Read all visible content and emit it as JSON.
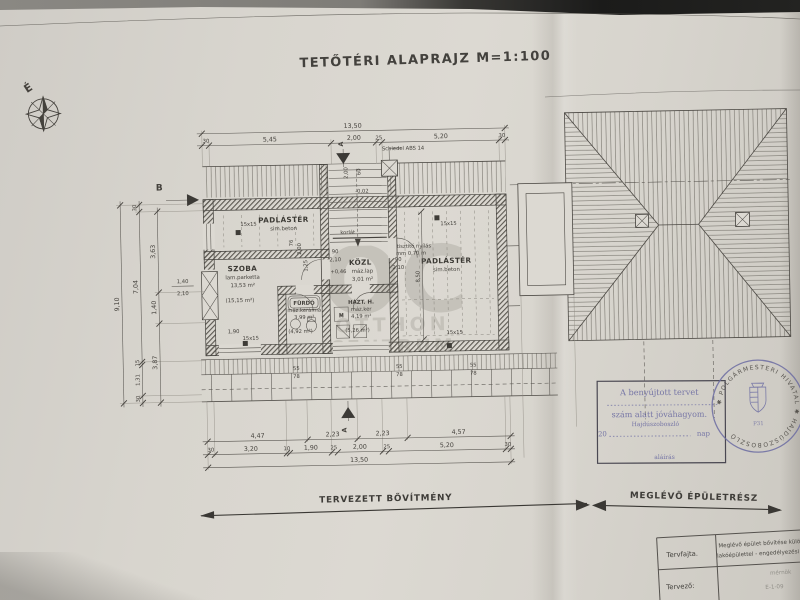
{
  "title": "TETŐTÉRI ALAPRAJZ M=1:100",
  "compass": {
    "north": "É"
  },
  "sections": {
    "a": "A",
    "b": "B"
  },
  "chimney_label": "Schiedel ABS 14",
  "rooms": {
    "attic_left": {
      "name": "PADLÁSTÉR",
      "finish": "sim.beton"
    },
    "szoba": {
      "name": "SZOBA",
      "finish": "lam.parketta",
      "area": "13,53 m²",
      "gross": "(15,15 m²)"
    },
    "kozl": {
      "name": "KÖZL",
      "finish": "máz.lap",
      "area": "3,01 m²",
      "level": "+0,46"
    },
    "furdo": {
      "name": "FÜRDŐ",
      "finish": "máz.kerámia",
      "area": "3,99 m²",
      "gross": "(4,92 m²)"
    },
    "hazt": {
      "name": "HÁZT. H.",
      "finish": "máz.ker",
      "area": "4,19 m²",
      "gross": "(5,26 m²)"
    },
    "attic_right": {
      "name": "PADLÁSTÉR",
      "finish": "sim.beton"
    }
  },
  "ann": {
    "korlat": "korlát",
    "tisztito1": "tisztító nyílás",
    "tisztito2": "mm 0,70 m",
    "column": "15x15",
    "washer": "M",
    "level_stair": "-0,02"
  },
  "dims": {
    "top_total": "13,50",
    "top_segments": [
      "30",
      "5,45",
      "2,00",
      "25",
      "5,20",
      "30"
    ],
    "bottom_row1": [
      "4,47",
      "2,23",
      "2,23",
      "4,57"
    ],
    "bottom_row2": [
      "30",
      "3,20",
      "10",
      "1,90",
      "25",
      "2,00",
      "25",
      "5,20",
      "30"
    ],
    "bottom_total": "13,50",
    "left_total": "9,10",
    "left_mid": [
      "30",
      "7,04",
      "15",
      "1,31",
      "30"
    ],
    "left_inner": [
      "3,63",
      "1,40",
      "3,87"
    ],
    "window_w": "1,40",
    "window_h": "2,10",
    "door_w": "90",
    "door_h": "2,10",
    "szoba_window": "1,90",
    "stair_w": "2,00",
    "stair_off": "60",
    "knee_a": "76",
    "knee_b": "2,00",
    "knee_c": "1,25",
    "room_depth": "8,50",
    "right_dims": [
      "8,50",
      "5,10",
      "8,10"
    ],
    "eaves_a": "55",
    "eaves_b": "78"
  },
  "legend": {
    "new": "TERVEZETT BŐVÍTMÉNY",
    "existing": "MEGLÉVŐ ÉPÜLETRÉSZ"
  },
  "stamp": {
    "line1": "A benyújtott tervet",
    "line2": "szám alatt jóváhagyom.",
    "city": "Hajdúszoboszló",
    "year": "20",
    "day": "nap",
    "sign": "aláírás",
    "seal_text": "✱ POLGÁRMESTERI HIVATAL ✱ HAJDÚSZOBOSZLÓ",
    "seal_num": "P31"
  },
  "titleblock": {
    "row1_label": "Tervfajta.",
    "row1_value1": "Meglévő épület bővítése különálló",
    "row1_value2": "lakóépülettel - engedélyezési terv",
    "row2_label": "Tervező:",
    "row2_value1": "mérnök",
    "row2_value2": "E-1-09"
  },
  "watermark": {
    "big": "OC",
    "l1": "OTTHON",
    "l2": "CENTRUM"
  }
}
